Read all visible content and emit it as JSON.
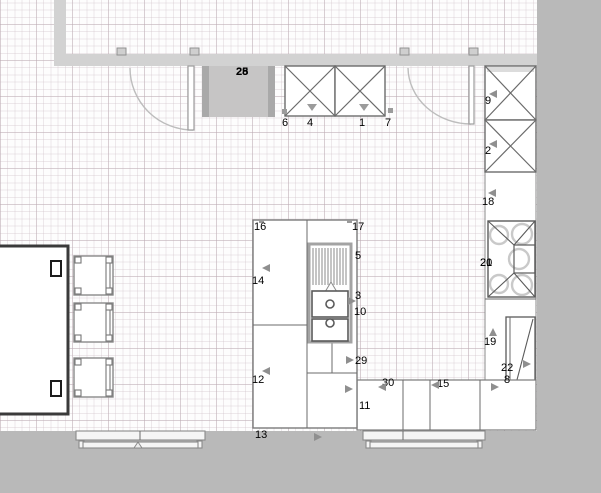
{
  "plan": {
    "title": "kitchen floor plan",
    "colors": {
      "wall": "#d2d2d2",
      "outside": "#b9b9b9",
      "line": "#6b6b6b",
      "marker": "#8f8f8f",
      "block": "#c6c5c5",
      "blockEdge": "#a9a9a9",
      "gridMinor": "rgba(204,188,196,0.32)",
      "gridMajor": "rgba(186,170,178,0.42)"
    },
    "labels": [
      {
        "text": "25",
        "x": 236,
        "y": 66,
        "bold": true
      },
      {
        "text": "28",
        "x": 236,
        "y": 66,
        "bold": true
      },
      {
        "text": "6",
        "x": 282,
        "y": 117
      },
      {
        "text": "4",
        "x": 307,
        "y": 117
      },
      {
        "text": "1",
        "x": 359,
        "y": 117
      },
      {
        "text": "7",
        "x": 385,
        "y": 117
      },
      {
        "text": "9",
        "x": 485,
        "y": 95
      },
      {
        "text": "2",
        "x": 485,
        "y": 145
      },
      {
        "text": "18",
        "x": 482,
        "y": 196
      },
      {
        "text": "20",
        "x": 480,
        "y": 257
      },
      {
        "text": "21",
        "x": 480,
        "y": 257
      },
      {
        "text": "19",
        "x": 484,
        "y": 336
      },
      {
        "text": "22",
        "x": 501,
        "y": 362
      },
      {
        "text": "8",
        "x": 504,
        "y": 374
      },
      {
        "text": "16",
        "x": 254,
        "y": 221
      },
      {
        "text": "17",
        "x": 352,
        "y": 221
      },
      {
        "text": "5",
        "x": 355,
        "y": 250
      },
      {
        "text": "14",
        "x": 252,
        "y": 275
      },
      {
        "text": "3",
        "x": 355,
        "y": 290
      },
      {
        "text": "10",
        "x": 354,
        "y": 306
      },
      {
        "text": "29",
        "x": 355,
        "y": 355
      },
      {
        "text": "12",
        "x": 252,
        "y": 374
      },
      {
        "text": "13",
        "x": 255,
        "y": 429
      },
      {
        "text": "30",
        "x": 382,
        "y": 377
      },
      {
        "text": "11",
        "x": 359,
        "y": 400
      },
      {
        "text": "15",
        "x": 437,
        "y": 378
      }
    ],
    "markers": [
      {
        "dir": "left",
        "x": 262,
        "y": 264
      },
      {
        "dir": "left",
        "x": 262,
        "y": 367
      },
      {
        "dir": "right",
        "x": 348,
        "y": 297
      },
      {
        "dir": "right",
        "x": 346,
        "y": 356
      },
      {
        "dir": "right",
        "x": 345,
        "y": 385
      },
      {
        "dir": "left",
        "x": 378,
        "y": 383
      },
      {
        "dir": "left",
        "x": 431,
        "y": 381
      },
      {
        "dir": "left",
        "x": 489,
        "y": 90
      },
      {
        "dir": "left",
        "x": 489,
        "y": 140
      },
      {
        "dir": "left",
        "x": 488,
        "y": 189
      },
      {
        "dir": "up",
        "x": 489,
        "y": 328
      },
      {
        "dir": "right",
        "x": 523,
        "y": 360
      },
      {
        "dir": "right",
        "x": 491,
        "y": 383
      },
      {
        "dir": "right",
        "x": 314,
        "y": 433
      }
    ]
  }
}
